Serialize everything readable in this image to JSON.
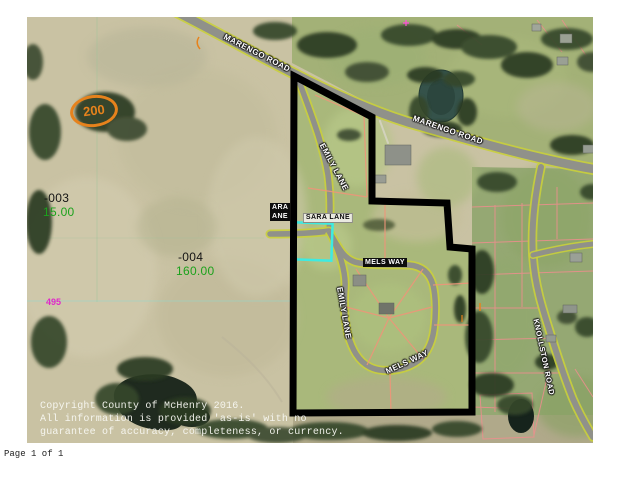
{
  "document": {
    "page_label": "Page 1 of 1",
    "copyright": {
      "line1": "Copyright County of McHenry 2016.",
      "line2": "All information is provided 'as-is' with no",
      "line3": "guarantee of accuracy, completeness, or currency."
    }
  },
  "map": {
    "roads": {
      "marengo_upper": "MARENGO ROAD",
      "marengo_lower": "MARENGO ROAD",
      "emily_upper": "EMILY LANE",
      "emily_lower": "EMILY LANE",
      "sara": "SARA LANE",
      "sara_clipped_line1": "ARA",
      "sara_clipped_line2": "ANE",
      "mels_north": "MELS WAY",
      "mels_south": "MELS WAY",
      "knollston": "KNOLLSTON ROAD"
    },
    "route_shield": "200",
    "road_ref": "495",
    "parcels": [
      {
        "id": "-003",
        "acres": "15.00"
      },
      {
        "id": "-004",
        "acres": "160.00"
      }
    ],
    "colors": {
      "selection_boundary": "#000000",
      "highlight_parcel": "#3debe2",
      "acreage_text": "#1ca21c",
      "parcel_id_text": "#141414",
      "ref_text": "#e028c8",
      "route_shield": "#e6821c",
      "lot_lines": "#ee9579",
      "parcel_grid": "#ef8e8e",
      "road_edge": "#c9cf3c"
    }
  }
}
